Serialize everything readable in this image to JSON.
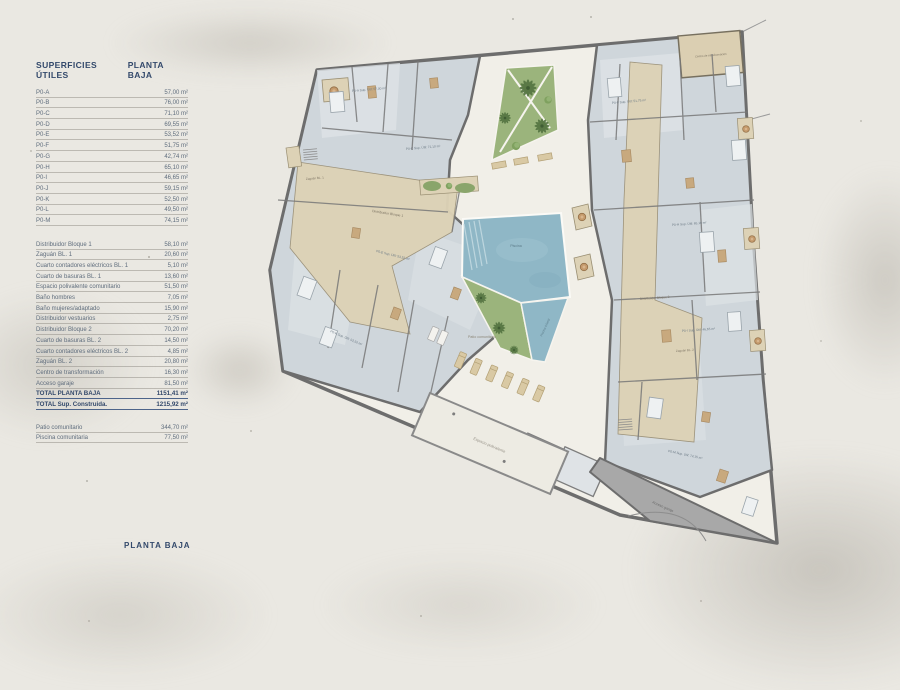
{
  "table": {
    "header": {
      "left": "SUPERFICIES ÚTILES",
      "right": "PLANTA BAJA"
    },
    "apartments": [
      {
        "label": "P0-A",
        "value": "57,00 m²"
      },
      {
        "label": "P0-B",
        "value": "76,00 m²"
      },
      {
        "label": "P0-C",
        "value": "71,10 m²"
      },
      {
        "label": "P0-D",
        "value": "69,55 m²"
      },
      {
        "label": "P0-E",
        "value": "53,52 m²"
      },
      {
        "label": "P0-F",
        "value": "51,75 m²"
      },
      {
        "label": "P0-G",
        "value": "42,74 m²"
      },
      {
        "label": "P0-H",
        "value": "65,10 m²"
      },
      {
        "label": "P0-I",
        "value": "46,65 m²"
      },
      {
        "label": "P0-J",
        "value": "59,15 m²"
      },
      {
        "label": "P0-K",
        "value": "52,50 m²"
      },
      {
        "label": "P0-L",
        "value": "49,50 m²"
      },
      {
        "label": "P0-M",
        "value": "74,15 m²"
      }
    ],
    "common": [
      {
        "label": "Distribuidor Bloque 1",
        "value": "58,10 m²"
      },
      {
        "label": "Zaguán BL. 1",
        "value": "20,60 m²"
      },
      {
        "label": "Cuarto contadores eléctricos BL. 1",
        "value": "5,10 m²"
      },
      {
        "label": "Cuarto de basuras BL. 1",
        "value": "13,60 m²"
      },
      {
        "label": "Espacio polivalente comunitario",
        "value": "51,50 m²"
      },
      {
        "label": "Baño hombres",
        "value": "7,05 m²"
      },
      {
        "label": "Baño mujeres/adaptado",
        "value": "15,90 m²"
      },
      {
        "label": "Distribuidor vestuarios",
        "value": "2,75 m²"
      },
      {
        "label": "Distribuidor Bloque 2",
        "value": "70,20 m²"
      },
      {
        "label": "Cuarto de basuras BL. 2",
        "value": "14,50 m²"
      },
      {
        "label": "Cuarto contadores eléctricos BL. 2",
        "value": "4,85 m²"
      },
      {
        "label": "Zaguán BL. 2",
        "value": "20,80 m²"
      },
      {
        "label": "Centro de transformación",
        "value": "16,30 m²"
      },
      {
        "label": "Acceso garaje",
        "value": "81,50 m²"
      }
    ],
    "totals": [
      {
        "label": "TOTAL PLANTA BAJA",
        "value": "1151,41 m²"
      },
      {
        "label": "TOTAL Sup. Construida.",
        "value": "1215,92 m²"
      }
    ],
    "outdoor": [
      {
        "label": "Patio comunitario",
        "value": "344,70 m²"
      },
      {
        "label": "Piscina comunitaria",
        "value": "77,50 m²"
      }
    ]
  },
  "caption": "PLANTA BAJA",
  "plan": {
    "labels": {
      "pool": "Piscina",
      "kids_pool": "Piscina infantil",
      "patio": "Patio comunitario",
      "multipurpose": "Espacio polivalente",
      "garage": "Acceso garaje",
      "dist1": "Distribuidor Bloque 1",
      "dist2": "Distribuidor Bloque 2",
      "zaguan1": "Zaguán BL. 1",
      "zaguan2": "Zaguán BL. 2",
      "transformer": "Centro de transformación",
      "p0a": "P0-A Sup. Útil: 57,00 m²",
      "p0c": "P0-C Sup. Útil: 71,10 m²",
      "p0e": "P0-E Sup. Útil: 53,52 m²",
      "p0k": "P0-K Sup. Útil: 52,50 m²",
      "p0f": "P0-F Sup. Útil: 51,75 m²",
      "p0h": "P0-H Sup. Útil: 65,10 m²",
      "p0i": "P0-I Sup. Útil: 46,65 m²",
      "p0m": "P0-M Sup. Útil: 74,15 m²"
    },
    "colors": {
      "navy": "#33496b",
      "wall": "#6d6d6d",
      "room": "#cfd6db",
      "corridor": "#ddd2b6",
      "garden": "#9bb47c",
      "pool": "#8fb7c6",
      "ramp": "#a8a8a8",
      "paper": "#f1efe8"
    }
  }
}
